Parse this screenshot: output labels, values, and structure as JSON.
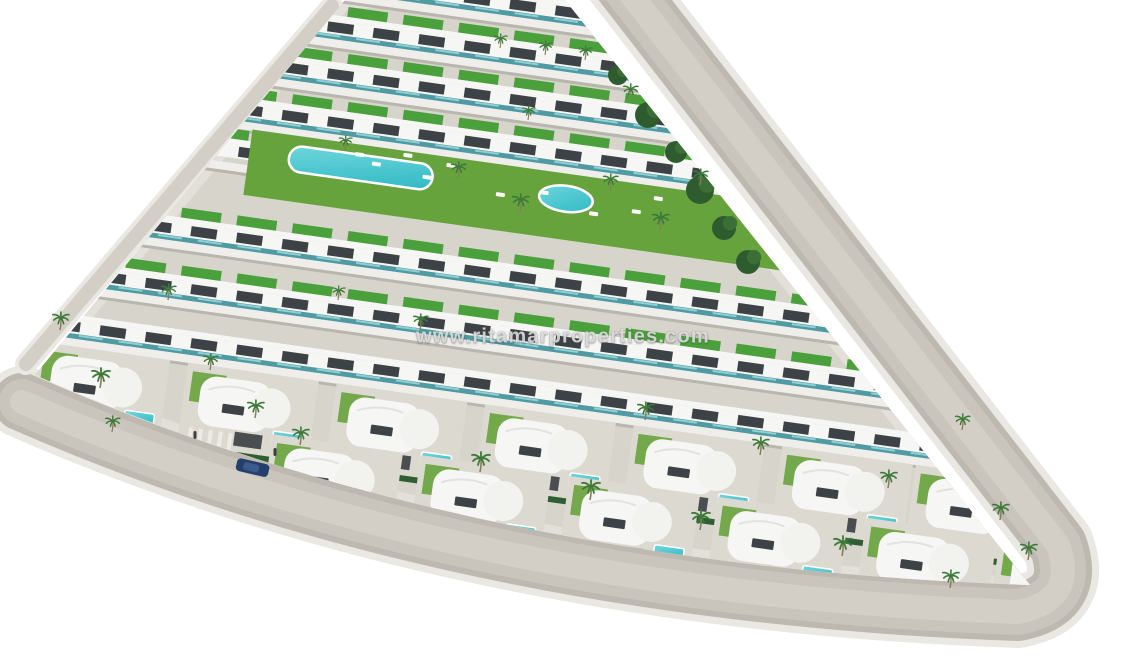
{
  "image": {
    "kind": "3d-aerial-render",
    "subject": "triangular residential development with apartment rows, curved villas, communal pools, private pools, palm trees and perimeter roads",
    "width_px": 1130,
    "height_px": 665
  },
  "watermark": {
    "text": "www.ritamarproperties.com"
  },
  "palette": {
    "background": "#ffffff",
    "ground": "#d7d4cc",
    "road_halo": "#eae8e2",
    "road_edge": "#beb9b0",
    "road": "#c9c5bc",
    "road_light": "#d3cfc7",
    "sidewalk": "#e3e0d9",
    "building_white": "#f6f6f4",
    "building_shade": "#e3e2de",
    "walkway": "#efeeea",
    "villa_pad": "#dcd9d1",
    "window_dark": "#3c4246",
    "glass_teal": "#4f9aa3",
    "glass_teal_light": "#8fd0d4",
    "roof_green": "#4aa13b",
    "lawn_green": "#67a33c",
    "hedge_green": "#2e5e31",
    "palm_green": "#3c7a38",
    "palm_trunk": "#8a7a5c",
    "tree_dark": "#2f5c2f",
    "tree_mid": "#3b6f35",
    "pool_teal": "#2fb9c4",
    "pool_teal_light": "#6fd6dc",
    "pool_rim": "#ffffff",
    "garage_dark": "#4a4e51",
    "car_blue": "#243f6b",
    "car_blue_light": "#3a5a8c",
    "person_dark": "#3f3f3f",
    "shadow": "#b9b6ae"
  },
  "scene": {
    "plot_path": "M345,0 L565,0 L1030,585 Q468,566 35,375 Z",
    "ring_road_path": "M612,-30 L1058,545 Q1078,600 1018,612 Q455,592 22,402",
    "left_road_path": "M332,6 L26,364",
    "row_angle_deg": 8,
    "building_rows": [
      {
        "y0": -90,
        "green": true,
        "teal": true
      },
      {
        "y0": -42,
        "green": true,
        "teal": true
      },
      {
        "y0": 5,
        "green": true,
        "teal": true
      },
      {
        "y0": 53,
        "green": true,
        "teal": true
      },
      {
        "y0": 96,
        "x0": 100,
        "x1": 260,
        "green": true,
        "teal": false
      },
      {
        "y0": 182,
        "green": true,
        "teal": true
      },
      {
        "y0": 240,
        "green": true,
        "teal": true
      },
      {
        "y0": 294,
        "green": false,
        "teal": true
      }
    ],
    "amenity": {
      "y0": 94,
      "x0": 255,
      "x1": 800,
      "height": 66,
      "main_pool": {
        "x": 295,
        "y": 10,
        "width": 145,
        "height": 26
      },
      "round_pool": {
        "cx": 575,
        "cy": 25,
        "rx": 27,
        "ry": 13
      },
      "loungers": [
        [
          360,
          8
        ],
        [
          378,
          15
        ],
        [
          430,
          21
        ],
        [
          452,
          6
        ],
        [
          505,
          28
        ],
        [
          548,
          20
        ],
        [
          600,
          34
        ],
        [
          642,
          26
        ],
        [
          662,
          10
        ],
        [
          408,
          2
        ]
      ]
    },
    "villa_rows": [
      {
        "y0": 336,
        "xs": [
          40,
          190,
          340,
          490,
          640,
          790,
          925
        ]
      },
      {
        "y0": 396,
        "xs": [
          275,
          425,
          575,
          725,
          875,
          1010
        ]
      }
    ],
    "trees": [
      [
        618,
        75,
        10
      ],
      [
        648,
        115,
        13
      ],
      [
        676,
        152,
        11
      ],
      [
        700,
        190,
        14
      ],
      [
        724,
        228,
        12
      ],
      [
        748,
        262,
        12
      ],
      [
        688,
        133,
        9
      ],
      [
        712,
        170,
        9
      ]
    ],
    "palms": [
      [
        60,
        330,
        0.9
      ],
      [
        100,
        388,
        1
      ],
      [
        168,
        300,
        0.8
      ],
      [
        255,
        418,
        0.9
      ],
      [
        338,
        300,
        0.7
      ],
      [
        300,
        445,
        0.9
      ],
      [
        420,
        330,
        0.8
      ],
      [
        458,
        178,
        0.8
      ],
      [
        520,
        212,
        0.9
      ],
      [
        345,
        150,
        0.7
      ],
      [
        610,
        190,
        0.8
      ],
      [
        660,
        230,
        0.9
      ],
      [
        700,
        185,
        0.8
      ],
      [
        480,
        472,
        1
      ],
      [
        590,
        500,
        1
      ],
      [
        645,
        420,
        0.9
      ],
      [
        700,
        530,
        1
      ],
      [
        760,
        455,
        0.9
      ],
      [
        842,
        556,
        1
      ],
      [
        888,
        488,
        0.9
      ],
      [
        950,
        588,
        0.9
      ],
      [
        1000,
        520,
        0.9
      ],
      [
        585,
        60,
        0.7
      ],
      [
        630,
        100,
        0.8
      ],
      [
        528,
        120,
        0.7
      ],
      [
        962,
        430,
        0.8
      ],
      [
        1028,
        560,
        0.9
      ],
      [
        112,
        432,
        0.8
      ],
      [
        210,
        370,
        0.8
      ],
      [
        500,
        48,
        0.7
      ],
      [
        545,
        55,
        0.7
      ]
    ],
    "car": {
      "x": 252,
      "y": 468,
      "angle": 13
    },
    "people": [
      [
        195,
        435
      ],
      [
        275,
        452
      ]
    ]
  }
}
